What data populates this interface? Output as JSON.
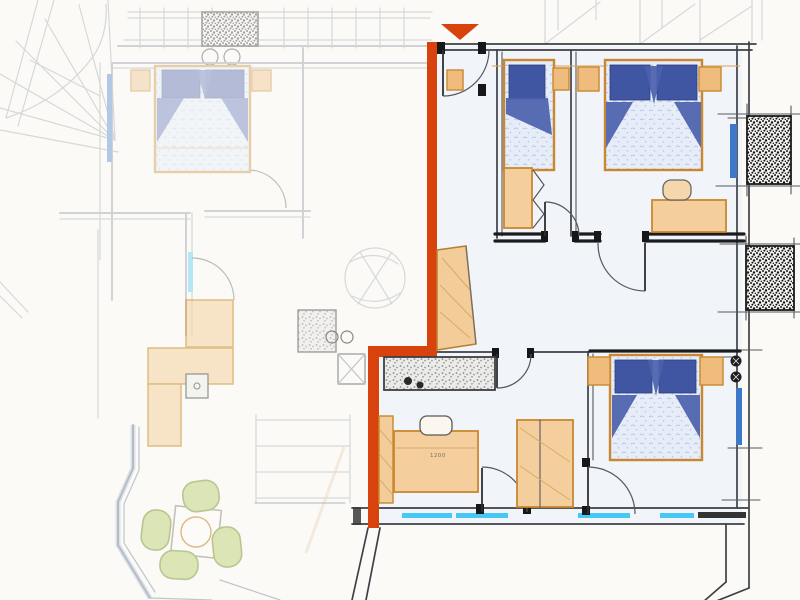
{
  "scene": {
    "type": "hand-drawn apartment floor plan sketch",
    "paper_color": "#fbfaf7",
    "adjacent_unit_fade": 0.38
  },
  "marker": {
    "symbol": "triangle-down",
    "color": "#d8420d"
  },
  "highlight": {
    "wall_color": "#d8420d"
  },
  "annotations": {
    "desk_dimension": "1200"
  },
  "palette": {
    "wall_dark": "#3d4046",
    "wall_heavy": "#1c1c1e",
    "bed_blue": "#4156a2",
    "bed_fold_blue": "#4c61ae",
    "bed_linen_light": "#e6edf9",
    "furniture_orange": "#f4cf9d",
    "furniture_orange_dark": "#f0bc7d",
    "furniture_orange_stroke": "#c9882f",
    "window_cyan": "#45c8f5",
    "window_blue": "#3e78c9",
    "chair_green": "#d4e0a6",
    "chair_green_stroke": "#a9ba79",
    "speckle_black": "#161616",
    "floor_tint": "#e8eefb"
  }
}
